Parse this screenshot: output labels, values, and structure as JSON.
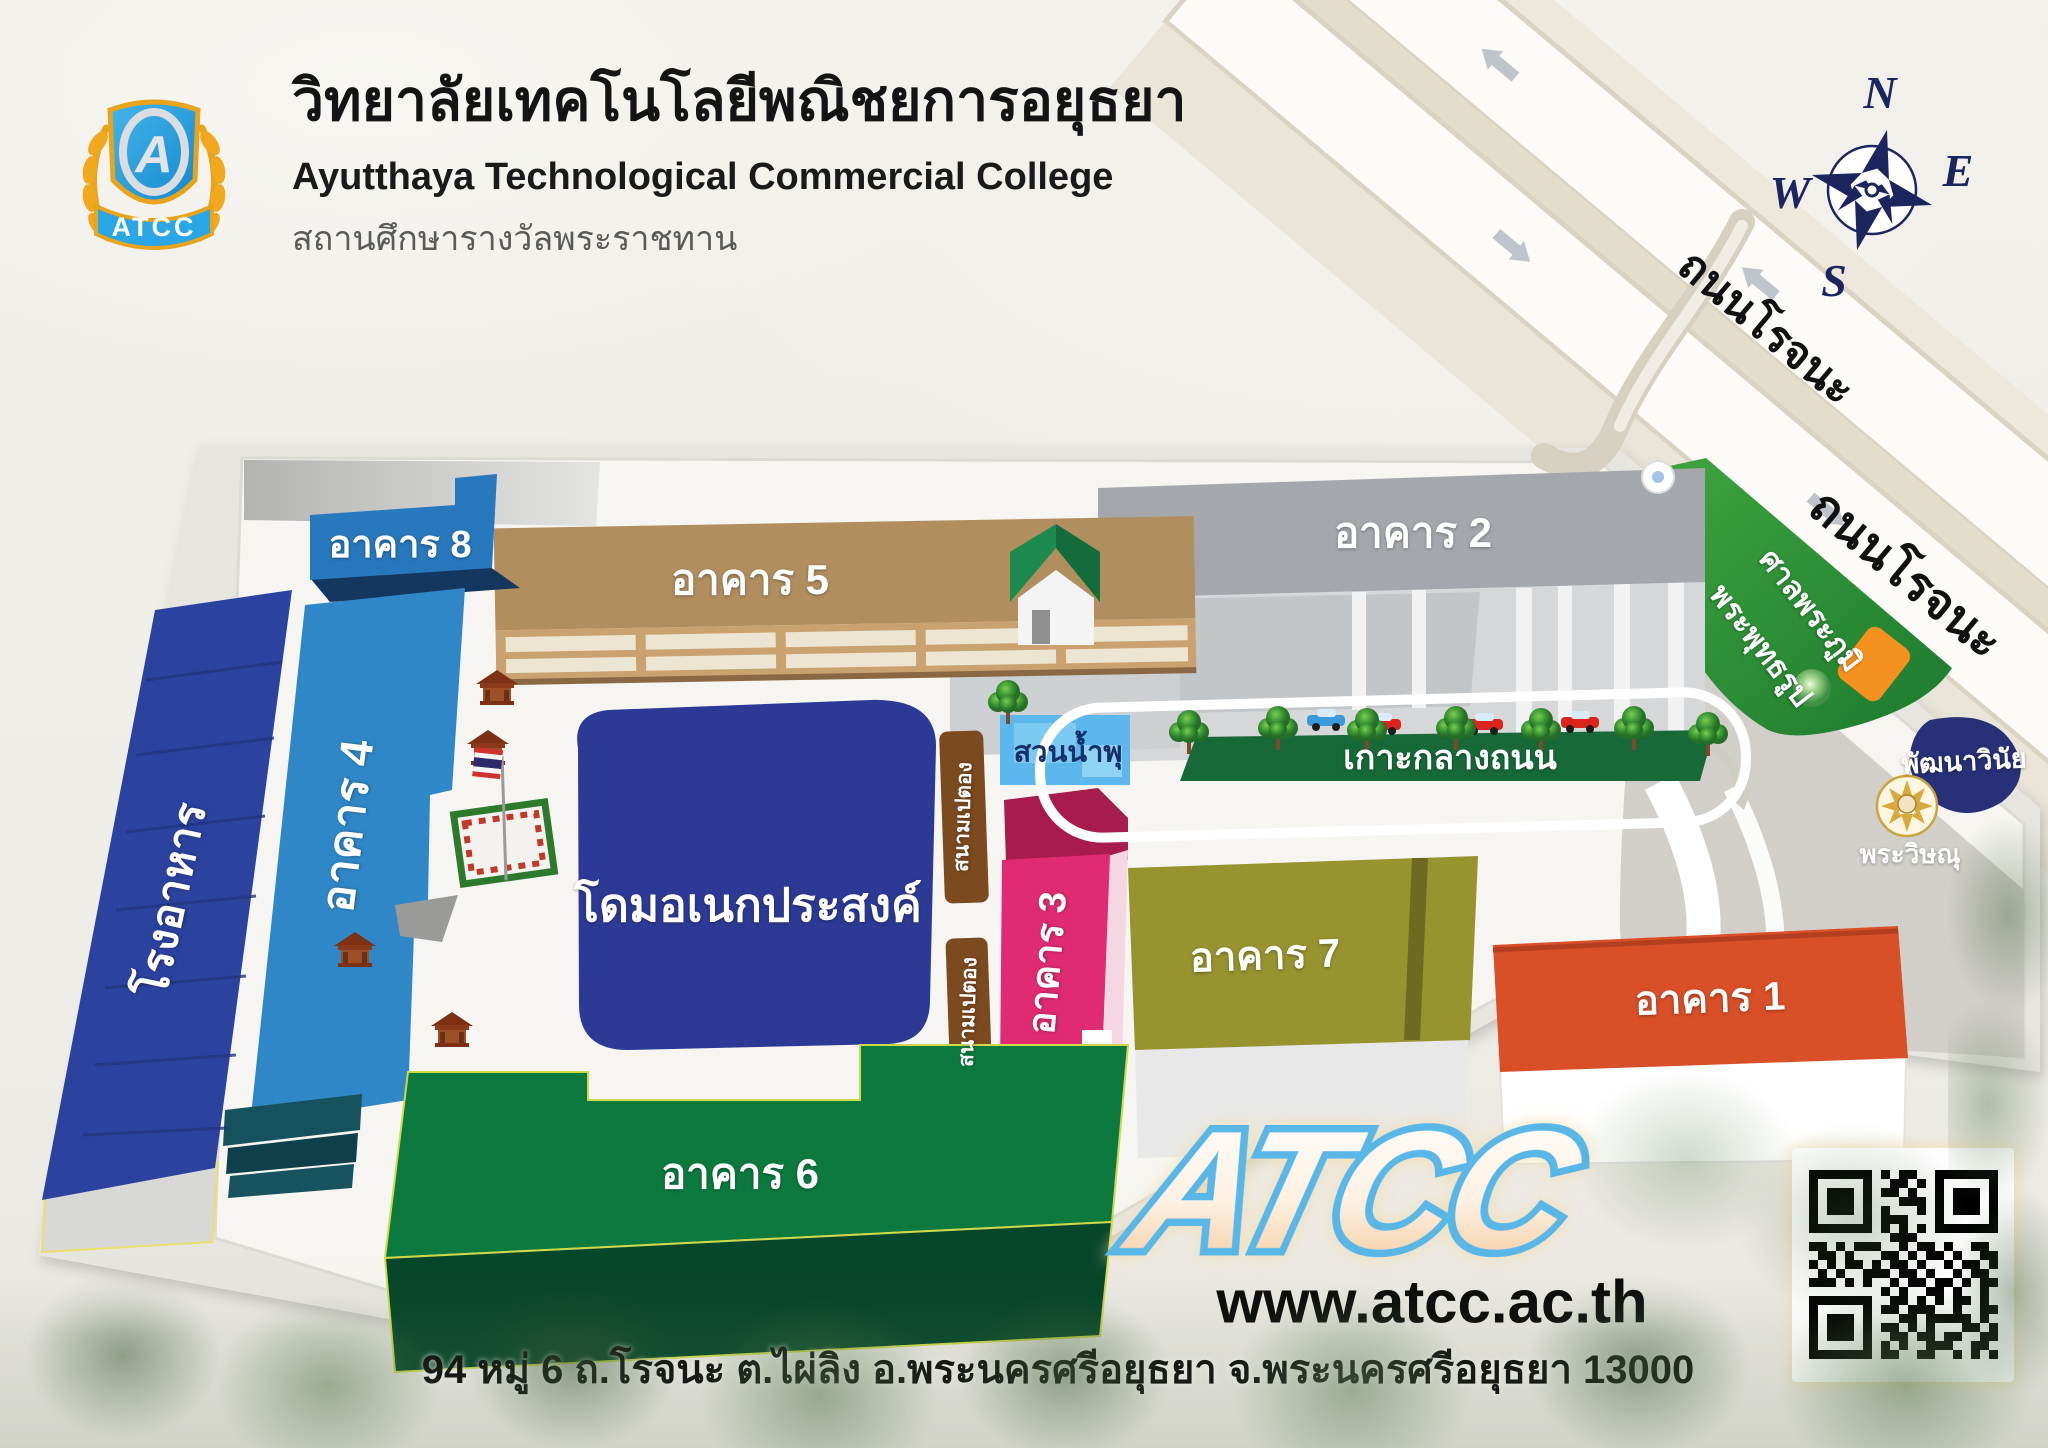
{
  "header": {
    "title_thai": "วิทยาลัยเทคโนโลยีพณิชยการอยุธยา",
    "title_english": "Ayutthaya Technological Commercial College",
    "subtitle_thai": "สถานศึกษารางวัลพระราชทาน",
    "logo_letter": "A",
    "logo_banner": "ATCC"
  },
  "compass": {
    "n": "N",
    "e": "E",
    "s": "S",
    "w": "W"
  },
  "roads": {
    "rojana_upper": "ถนนโรจนะ",
    "rojana_lower": "ถนนโรจนะ"
  },
  "map": {
    "buildings": {
      "b1": "อาคาร 1",
      "b2": "อาคาร 2",
      "b3": "อาคาร 3",
      "b4": "อาคาร 4",
      "b5": "อาคาร 5",
      "b6": "อาคาร 6",
      "b7": "อาคาร 7",
      "b8": "อาคาร 8",
      "canteen": "โรงอาหาร",
      "dome": "โดมอเนกประสงค์",
      "fountain": "สวนน้ำพุ",
      "petanque": "สนามเปตอง"
    },
    "landmarks": {
      "median": "เกาะกลางถนน",
      "spirit_house": "ศาลพระภูมิ",
      "buddha": "พระพุทธรูป",
      "discipline": "พัฒนาวินัย",
      "vishnu": "พระวิษณุ"
    },
    "colors": {
      "b1_roof": "#d84f28",
      "b2_roof": "#a4a8ad",
      "b3_main": "#e02b72",
      "b4": "#2f87c7",
      "b5_roof": "#b18e5e",
      "b6_top": "#0c7a3f",
      "b7_roof": "#97932f",
      "b8": "#2878bd",
      "canteen": "#2b429f",
      "dome": "#2c3a96",
      "fountain": "#5cb8ec",
      "petanque": "#7c4a1f",
      "median_green": "#176a38",
      "grass": "#2f9637",
      "shrine_orange": "#f5921f",
      "navy": "#1d255f",
      "atcc_blue": "#58b7e7"
    }
  },
  "footer": {
    "logo": "ATCC",
    "website": "www.atcc.ac.th",
    "address": "94 หมู่ 6 ถ.โรจนะ ต.ไผ่ลิง อ.พระนครศรีอยุธยา จ.พระนครศรีอยุธยา 13000"
  },
  "qr_pattern": [
    "111111101011001111111",
    "100000100110101000001",
    "101110101101001011101",
    "101110100011101011101",
    "101110101000101011101",
    "100000101110001000001",
    "111111101010101111111",
    "000000000111000000000",
    "110101110010110100110",
    "011010001101011010011",
    "101011010110100101101",
    "010100111011010010110",
    "111010100101101101011",
    "000000001010011010010",
    "111111100110101011010",
    "100000101101110010011",
    "101110100011011111010",
    "101110101101010001101",
    "101110100110110110011",
    "100000101010011100110",
    "111111101100110010101"
  ]
}
